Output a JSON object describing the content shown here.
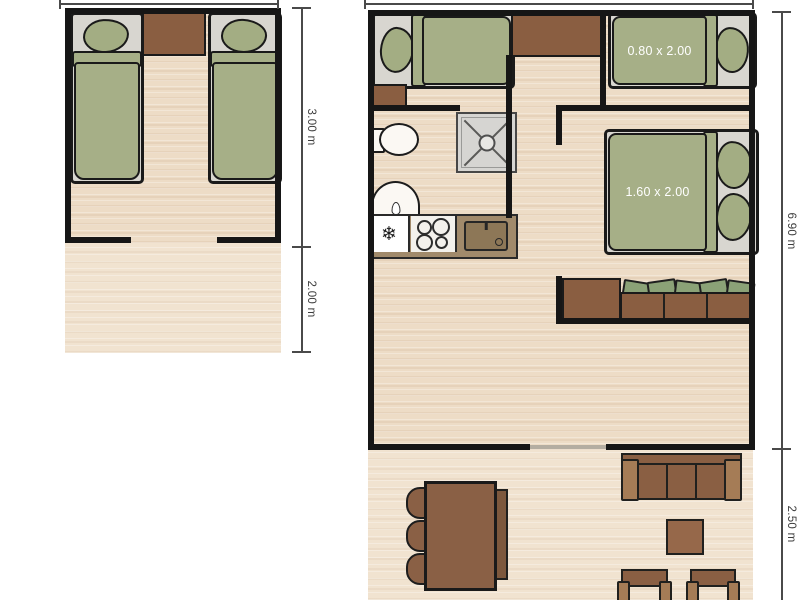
{
  "left_plan": {
    "name": "twin bedroom unit with terrace",
    "dim_upper": "3.00 m",
    "dim_lower": "2.00 m"
  },
  "right_plan": {
    "name": "main lodge unit with terrace",
    "single_bed_size": "0.80 x 2.00",
    "double_bed_size": "1.60 x 2.00",
    "dim_upper": "6.90 m",
    "dim_lower": "2.50 m",
    "kitchen": {
      "fridge_icon_glyph": "❄"
    }
  },
  "colors": {
    "wall": "#161616",
    "floor_wood": "#eddcc6",
    "terrace_wood": "#f1e3d0",
    "duvet_green": "#a6af87",
    "cushion_green": "#8ba277",
    "furniture_brown": "#8a5e41",
    "armrest_brown": "#a57c56",
    "counter_brown": "#a18a6b",
    "shower_gray": "#d6d5d2",
    "dimension_line": "#4a4a4a",
    "bed_label_text": "#ffffff"
  }
}
